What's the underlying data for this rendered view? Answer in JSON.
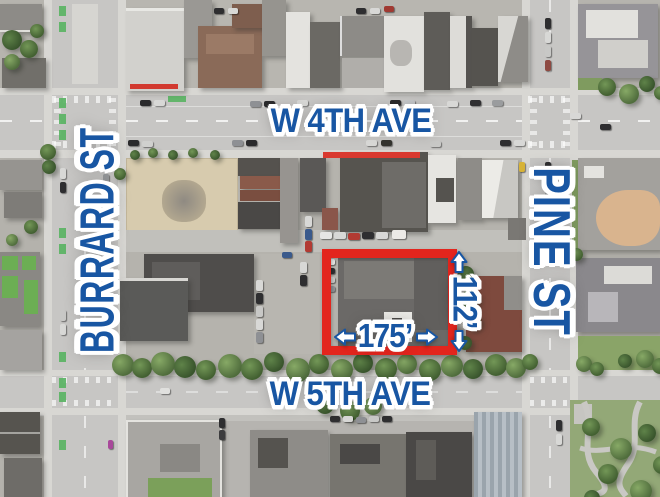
{
  "map_annotations": {
    "street_labels": {
      "top": "W 4TH AVE",
      "bottom": "W 5TH AVE",
      "left": "BURRARD ST",
      "right": "PINE ST"
    },
    "parcel_dimensions": {
      "frontage": "175’",
      "depth": "112’"
    },
    "colors": {
      "label_blue": "#1856a3",
      "parcel_red": "#e3251d"
    }
  }
}
